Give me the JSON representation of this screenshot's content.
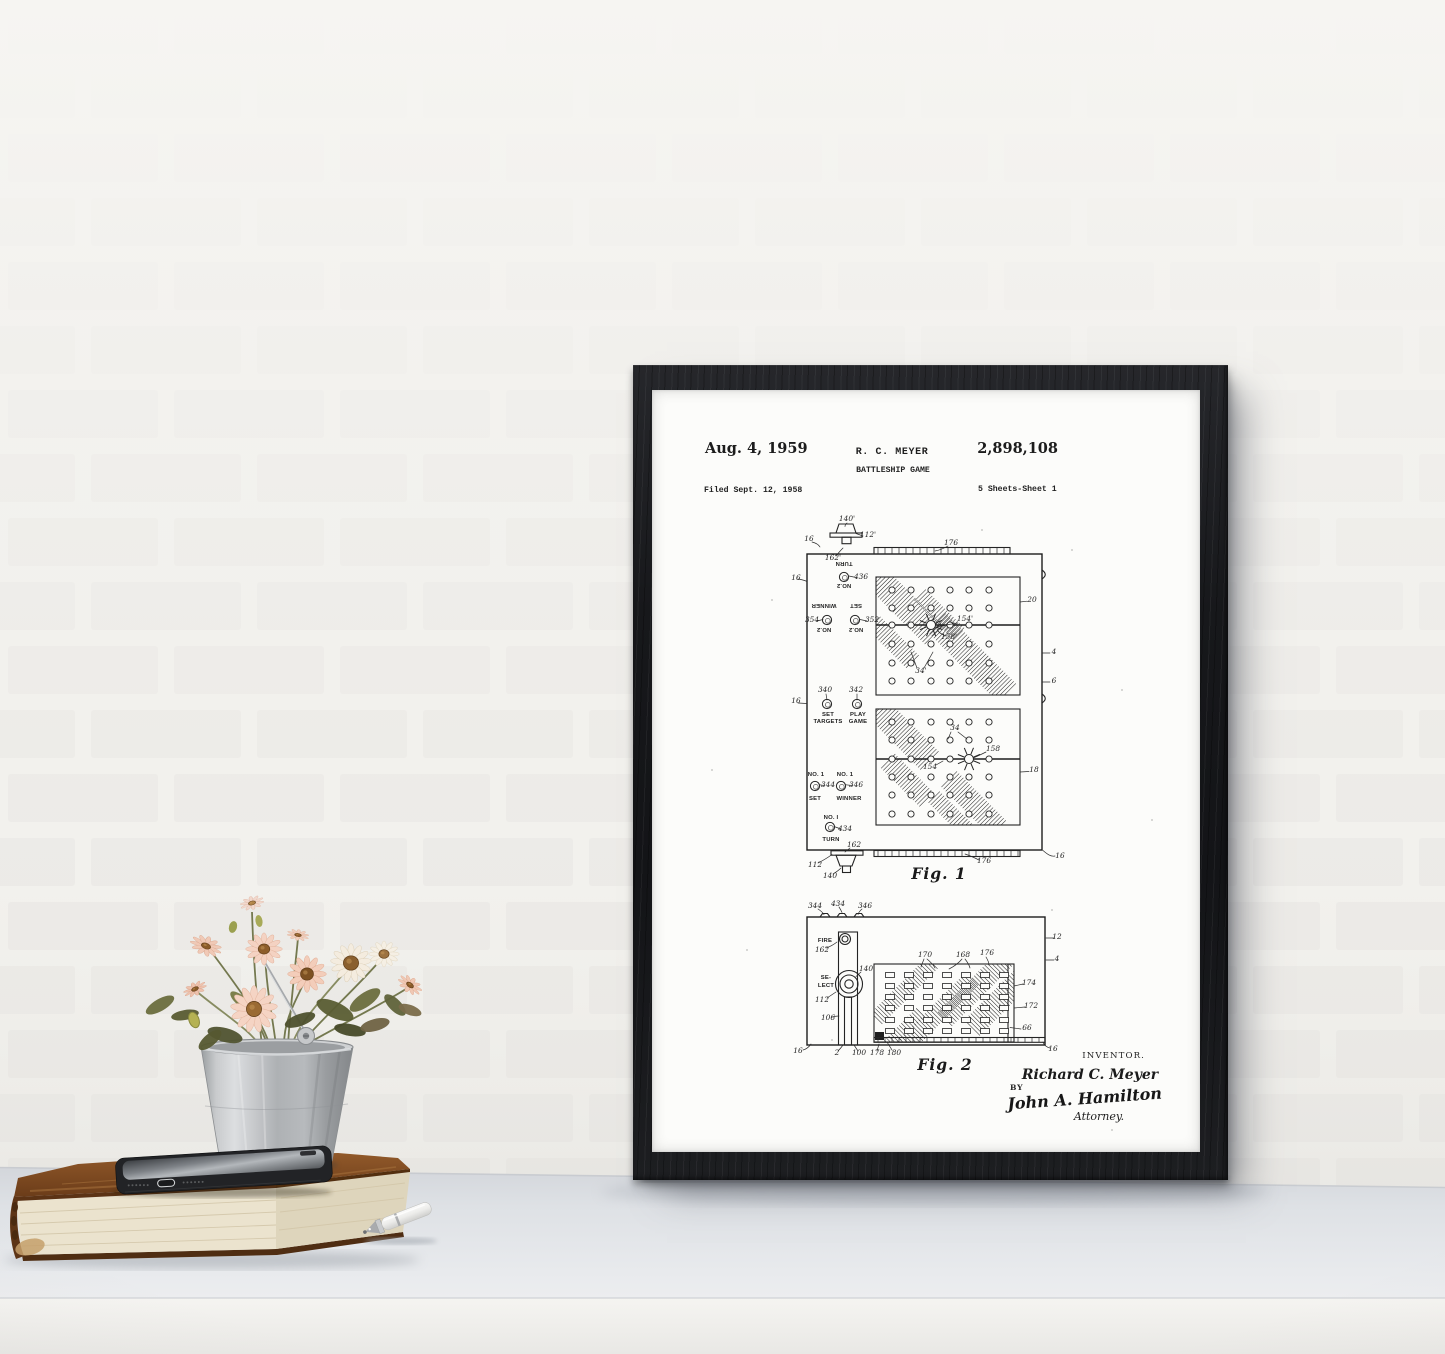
{
  "patent": {
    "header": {
      "date": "Aug. 4, 1959",
      "inventor": "R. C. MEYER",
      "number": "2,898,108",
      "title": "BATTLESHIP GAME",
      "filed": "Filed Sept. 12, 1958",
      "sheets": "5 Sheets-Sheet 1"
    },
    "fig1_caption": "Fig. 1",
    "fig2_caption": "Fig. 2",
    "signature_block": {
      "inventor_label": "INVENTOR.",
      "inventor_name": "Richard C. Meyer",
      "by": "BY",
      "attorney_name": "John A. Hamilton",
      "attorney_label": "Attorney."
    },
    "fig_labels": [
      {
        "t": "140'",
        "x": 195,
        "y": 131
      },
      {
        "t": "112'",
        "x": 216,
        "y": 147
      },
      {
        "t": "16",
        "x": 157,
        "y": 151
      },
      {
        "t": "162'",
        "x": 181,
        "y": 170
      },
      {
        "t": "176",
        "x": 299,
        "y": 155
      },
      {
        "t": "TURN",
        "x": 192,
        "y": 177,
        "k": "btn",
        "r": 180
      },
      {
        "t": "436",
        "x": 209,
        "y": 189
      },
      {
        "t": "NO.2",
        "x": 192,
        "y": 199,
        "k": "btn",
        "r": 180
      },
      {
        "t": "16",
        "x": 144,
        "y": 190
      },
      {
        "t": "WINNER",
        "x": 172,
        "y": 219,
        "k": "btn",
        "r": 180
      },
      {
        "t": "SET",
        "x": 204,
        "y": 219,
        "k": "btn",
        "r": 180
      },
      {
        "t": "354",
        "x": 160,
        "y": 232
      },
      {
        "t": "352",
        "x": 220,
        "y": 232
      },
      {
        "t": "NO.2",
        "x": 172,
        "y": 243,
        "k": "btn",
        "r": 180
      },
      {
        "t": "NO.2",
        "x": 204,
        "y": 243,
        "k": "btn",
        "r": 180
      },
      {
        "t": "20",
        "x": 380,
        "y": 212
      },
      {
        "t": "154'",
        "x": 313,
        "y": 231
      },
      {
        "t": "158'",
        "x": 297,
        "y": 249
      },
      {
        "t": "34'",
        "x": 269,
        "y": 283
      },
      {
        "t": "4",
        "x": 402,
        "y": 264
      },
      {
        "t": "6",
        "x": 402,
        "y": 293
      },
      {
        "t": "340",
        "x": 173,
        "y": 302
      },
      {
        "t": "342",
        "x": 204,
        "y": 302
      },
      {
        "t": "16",
        "x": 144,
        "y": 313
      },
      {
        "t": "SET",
        "x": 176,
        "y": 326,
        "k": "btn"
      },
      {
        "t": "TARGETS",
        "x": 176,
        "y": 333,
        "k": "btn"
      },
      {
        "t": "PLAY",
        "x": 206,
        "y": 326,
        "k": "btn"
      },
      {
        "t": "GAME",
        "x": 206,
        "y": 333,
        "k": "btn"
      },
      {
        "t": "34",
        "x": 303,
        "y": 340
      },
      {
        "t": "158",
        "x": 341,
        "y": 361
      },
      {
        "t": "154",
        "x": 278,
        "y": 379
      },
      {
        "t": "18",
        "x": 382,
        "y": 382
      },
      {
        "t": "NO. 1",
        "x": 164,
        "y": 386,
        "k": "btn"
      },
      {
        "t": "NO. 1",
        "x": 193,
        "y": 386,
        "k": "btn"
      },
      {
        "t": "344",
        "x": 176,
        "y": 397
      },
      {
        "t": "346",
        "x": 204,
        "y": 397
      },
      {
        "t": "SET",
        "x": 163,
        "y": 410,
        "k": "btn"
      },
      {
        "t": "WINNER",
        "x": 197,
        "y": 410,
        "k": "btn"
      },
      {
        "t": "NO. I",
        "x": 179,
        "y": 429,
        "k": "btn"
      },
      {
        "t": "434",
        "x": 193,
        "y": 441
      },
      {
        "t": "TURN",
        "x": 179,
        "y": 451,
        "k": "btn"
      },
      {
        "t": "162",
        "x": 202,
        "y": 457
      },
      {
        "t": "112",
        "x": 163,
        "y": 477
      },
      {
        "t": "140",
        "x": 178,
        "y": 488
      },
      {
        "t": "176",
        "x": 332,
        "y": 473
      },
      {
        "t": "16",
        "x": 408,
        "y": 468
      },
      {
        "t": "344",
        "x": 163,
        "y": 518
      },
      {
        "t": "434",
        "x": 186,
        "y": 516
      },
      {
        "t": "346",
        "x": 213,
        "y": 518
      },
      {
        "t": "FIRE",
        "x": 173,
        "y": 552,
        "k": "btn",
        "s": 7
      },
      {
        "t": "162",
        "x": 170,
        "y": 562
      },
      {
        "t": "SE-",
        "x": 174,
        "y": 589,
        "k": "btn",
        "s": 6.6
      },
      {
        "t": "LECT",
        "x": 174,
        "y": 597,
        "k": "btn",
        "s": 6.6
      },
      {
        "t": "140",
        "x": 214,
        "y": 581
      },
      {
        "t": "112",
        "x": 170,
        "y": 612
      },
      {
        "t": "106",
        "x": 176,
        "y": 630
      },
      {
        "t": "170",
        "x": 273,
        "y": 567
      },
      {
        "t": "168",
        "x": 311,
        "y": 567
      },
      {
        "t": "176",
        "x": 335,
        "y": 565
      },
      {
        "t": "174",
        "x": 377,
        "y": 595
      },
      {
        "t": "172",
        "x": 379,
        "y": 618
      },
      {
        "t": "66",
        "x": 375,
        "y": 640
      },
      {
        "t": "12",
        "x": 405,
        "y": 549
      },
      {
        "t": "4",
        "x": 405,
        "y": 571
      },
      {
        "t": "16",
        "x": 146,
        "y": 663
      },
      {
        "t": "2",
        "x": 185,
        "y": 665
      },
      {
        "t": "100",
        "x": 207,
        "y": 665
      },
      {
        "t": "178",
        "x": 225,
        "y": 665
      },
      {
        "t": "180",
        "x": 242,
        "y": 665
      },
      {
        "t": "16",
        "x": 401,
        "y": 661
      }
    ]
  },
  "palette": {
    "frame_black": "#17181b",
    "paper_white": "#fcfcfa",
    "ink": "#212121",
    "wall_mortar": "#f3f2ee",
    "wall_brick": "#e8e7e3",
    "table_top": "#dfe2e6",
    "table_front": "#f3f2ef",
    "book_cover_brown": "#7c4a21",
    "book_pages_cream": "#ebe3ce",
    "bucket_silver": "#b6b9bc",
    "flower_peach": "#f3cdbb",
    "flower_cream": "#f4ecdf",
    "flower_center_brown": "#8d5d2a",
    "leaf_olive": "#5d6135",
    "phone_black": "#222326",
    "pen_white": "#f2f2f0"
  }
}
